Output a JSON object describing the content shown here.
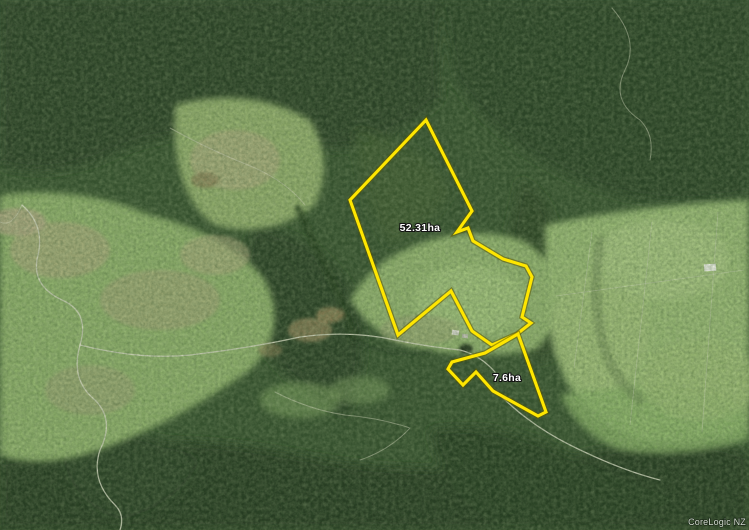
{
  "map": {
    "kind": "aerial-satellite-photo",
    "watermark_text": "CoreLogic NZ",
    "boundary_color": "#ffe600",
    "parcels": [
      {
        "area_label": "52.31ha",
        "points": "426,120 472,211 457,232 468,228 473,241 503,259 526,266 532,277 522,317 531,323 517,334 492,345 472,331 451,291 398,335 350,200",
        "label_x": "420",
        "label_y": "231"
      },
      {
        "area_label": "7.6ha",
        "points": "518,334 546,412 538,416 493,391 476,372 463,385 448,369 452,362 485,353",
        "label_x": "507",
        "label_y": "381"
      }
    ]
  }
}
